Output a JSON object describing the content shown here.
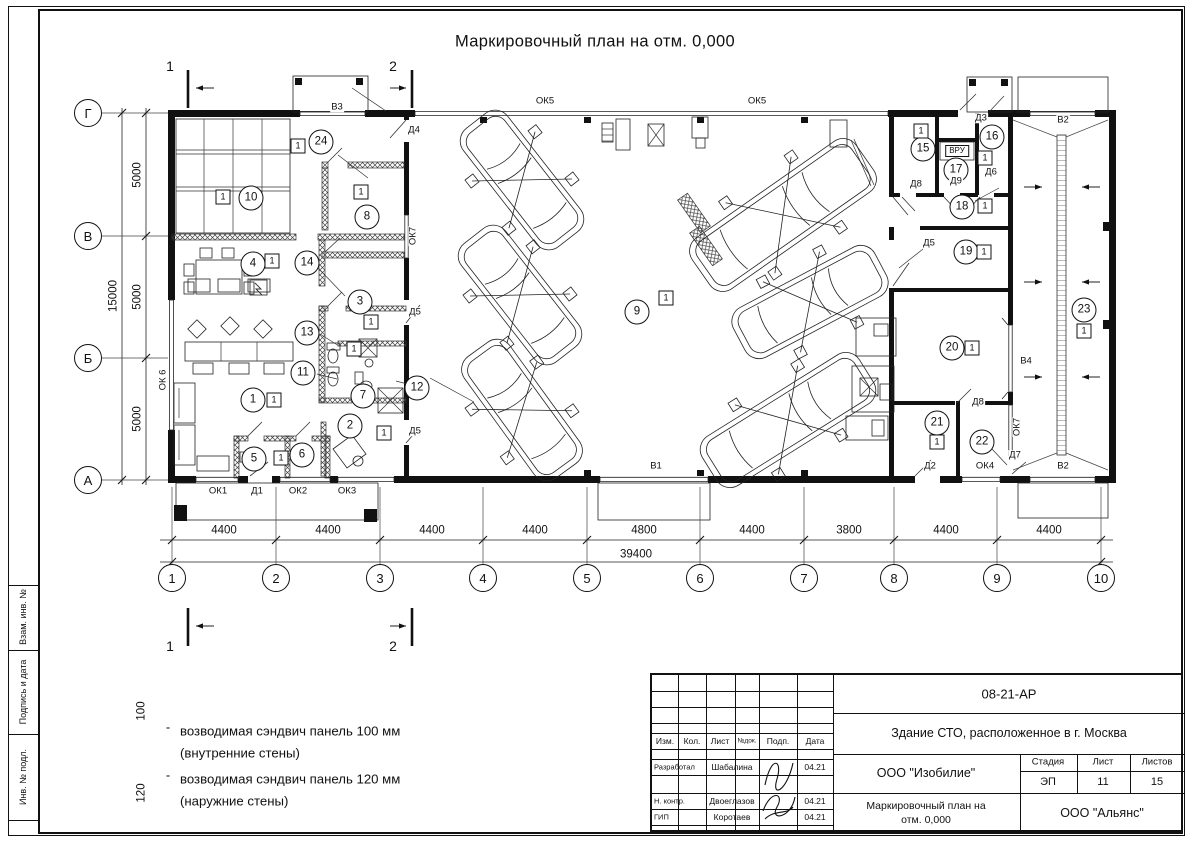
{
  "sheet": {
    "title": "Маркировочный план на отм. 0,000",
    "background": "#ffffff",
    "line_color": "#111111"
  },
  "sidebar": {
    "boxes": [
      {
        "label": "Взам. инв. №"
      },
      {
        "label": "Подпись и дата"
      },
      {
        "label": "Инв. № подл."
      }
    ]
  },
  "legend": {
    "dash": "-",
    "items": [
      {
        "thickness": "100",
        "line1": "возводимая сэндвич панель 100 мм",
        "line2": "(внутренние стены)"
      },
      {
        "thickness": "120",
        "line1": "возводимая сэндвич панель 120 мм",
        "line2": "(наружние стены)"
      }
    ]
  },
  "stamp": {
    "doc_number": "08-21-АР",
    "project_title": "Здание СТО, расположенное в г. Москва",
    "header_cells": [
      "Изм.",
      "Кол.",
      "Лист",
      "№док.",
      "Подп.",
      "Дата"
    ],
    "rows": [
      {
        "role": "Разработал",
        "name": "Шабалина",
        "date": "04.21"
      },
      {
        "role": "Н. контр.",
        "name": "Двоеглазов",
        "date": "04.21"
      },
      {
        "role": "ГИП",
        "name": "Коротаев",
        "date": "04.21"
      }
    ],
    "company": "ООО \"Изобилие\"",
    "stage_label": "Стадия",
    "stage": "ЭП",
    "sheet_label": "Лист",
    "sheet_no": "11",
    "sheets_label": "Листов",
    "sheets_total": "15",
    "drawing_name_line1": "Маркировочный план на",
    "drawing_name_line2": "отм. 0,000",
    "contractor": "ООО \"Альянс\""
  },
  "plan": {
    "axes_bottom": [
      {
        "label": "1",
        "x": 172
      },
      {
        "label": "2",
        "x": 276
      },
      {
        "label": "3",
        "x": 380
      },
      {
        "label": "4",
        "x": 483
      },
      {
        "label": "5",
        "x": 587
      },
      {
        "label": "6",
        "x": 700
      },
      {
        "label": "7",
        "x": 804
      },
      {
        "label": "8",
        "x": 894
      },
      {
        "label": "9",
        "x": 997
      },
      {
        "label": "10",
        "x": 1101
      }
    ],
    "axes_left": [
      {
        "label": "Г",
        "y": 113
      },
      {
        "label": "В",
        "y": 236
      },
      {
        "label": "Б",
        "y": 358
      },
      {
        "label": "А",
        "y": 480
      }
    ],
    "dims_bottom": [
      {
        "text": "4400",
        "x": 224
      },
      {
        "text": "4400",
        "x": 328
      },
      {
        "text": "4400",
        "x": 432
      },
      {
        "text": "4400",
        "x": 535
      },
      {
        "text": "4800",
        "x": 644
      },
      {
        "text": "4400",
        "x": 752
      },
      {
        "text": "3800",
        "x": 849
      },
      {
        "text": "4400",
        "x": 946
      },
      {
        "text": "4400",
        "x": 1049
      }
    ],
    "dim_total_bottom": {
      "text": "39400",
      "x": 636,
      "y": 555
    },
    "dims_left": [
      {
        "text": "5000",
        "y": 175
      },
      {
        "text": "5000",
        "y": 297
      },
      {
        "text": "5000",
        "y": 419
      }
    ],
    "dim_total_left": {
      "text": "15000",
      "x": 114,
      "y": 296
    },
    "section_marks": [
      "1",
      "2"
    ],
    "rooms": [
      {
        "num": "1",
        "x": 253,
        "y": 400,
        "bx": 274,
        "by": 400
      },
      {
        "num": "2",
        "x": 350,
        "y": 426,
        "bx": 384,
        "by": 433
      },
      {
        "num": "3",
        "x": 360,
        "y": 302,
        "bx": 371,
        "by": 322
      },
      {
        "num": "4",
        "x": 253,
        "y": 264,
        "bx": 272,
        "by": 261
      },
      {
        "num": "5",
        "x": 254,
        "y": 459
      },
      {
        "num": "6",
        "x": 302,
        "y": 455,
        "bx": 281,
        "by": 458
      },
      {
        "num": "7",
        "x": 363,
        "y": 396
      },
      {
        "num": "8",
        "x": 367,
        "y": 217,
        "bx": 361,
        "by": 192
      },
      {
        "num": "9",
        "x": 637,
        "y": 312,
        "bx": 666,
        "by": 298
      },
      {
        "num": "10",
        "x": 251,
        "y": 198,
        "bx": 223,
        "by": 197
      },
      {
        "num": "11",
        "x": 303,
        "y": 373
      },
      {
        "num": "12",
        "x": 417,
        "y": 388
      },
      {
        "num": "13",
        "x": 307,
        "y": 333,
        "bx": 354,
        "by": 349
      },
      {
        "num": "14",
        "x": 307,
        "y": 263
      },
      {
        "num": "15",
        "x": 923,
        "y": 149,
        "bx": 921,
        "by": 131
      },
      {
        "num": "16",
        "x": 992,
        "y": 137,
        "bx": 985,
        "by": 158
      },
      {
        "num": "17",
        "x": 956,
        "y": 170
      },
      {
        "num": "18",
        "x": 962,
        "y": 207,
        "bx": 985,
        "by": 206
      },
      {
        "num": "19",
        "x": 966,
        "y": 252,
        "bx": 984,
        "by": 252
      },
      {
        "num": "20",
        "x": 952,
        "y": 348,
        "bx": 972,
        "by": 348
      },
      {
        "num": "21",
        "x": 937,
        "y": 423,
        "bx": 937,
        "by": 442
      },
      {
        "num": "22",
        "x": 982,
        "y": 442
      },
      {
        "num": "23",
        "x": 1084,
        "y": 310,
        "bx": 1084,
        "by": 331
      },
      {
        "num": "24",
        "x": 321,
        "y": 142,
        "bx": 298,
        "by": 146
      }
    ],
    "openings": [
      {
        "text": "ОК1",
        "x": 218,
        "y": 491
      },
      {
        "text": "Д1",
        "x": 257,
        "y": 491
      },
      {
        "text": "ОК2",
        "x": 298,
        "y": 491
      },
      {
        "text": "ОК3",
        "x": 347,
        "y": 491
      },
      {
        "text": "ОК 6",
        "x": 163,
        "y": 380,
        "rot": true
      },
      {
        "text": "ОК5",
        "x": 545,
        "y": 101
      },
      {
        "text": "ОК5",
        "x": 757,
        "y": 101
      },
      {
        "text": "В3",
        "x": 337,
        "y": 107
      },
      {
        "text": "Д4",
        "x": 414,
        "y": 130
      },
      {
        "text": "ОК7",
        "x": 413,
        "y": 236,
        "rot": true
      },
      {
        "text": "Д5",
        "x": 415,
        "y": 312
      },
      {
        "text": "Д5",
        "x": 415,
        "y": 431
      },
      {
        "text": "Д5",
        "x": 929,
        "y": 243
      },
      {
        "text": "Д8",
        "x": 916,
        "y": 184
      },
      {
        "text": "Д9",
        "x": 956,
        "y": 181
      },
      {
        "text": "Д6",
        "x": 991,
        "y": 172
      },
      {
        "text": "Д3",
        "x": 981,
        "y": 118
      },
      {
        "text": "Д8",
        "x": 978,
        "y": 402
      },
      {
        "text": "В4",
        "x": 1026,
        "y": 361
      },
      {
        "text": "ОК7",
        "x": 1017,
        "y": 427,
        "rot": true
      },
      {
        "text": "Д2",
        "x": 930,
        "y": 466
      },
      {
        "text": "ОК4",
        "x": 985,
        "y": 466
      },
      {
        "text": "Д7",
        "x": 1015,
        "y": 455
      },
      {
        "text": "В2",
        "x": 1063,
        "y": 120
      },
      {
        "text": "В2",
        "x": 1063,
        "y": 466
      },
      {
        "text": "В1",
        "x": 656,
        "y": 466
      },
      {
        "text": "ВРУ",
        "x": 957,
        "y": 151,
        "boxed": true
      }
    ]
  }
}
